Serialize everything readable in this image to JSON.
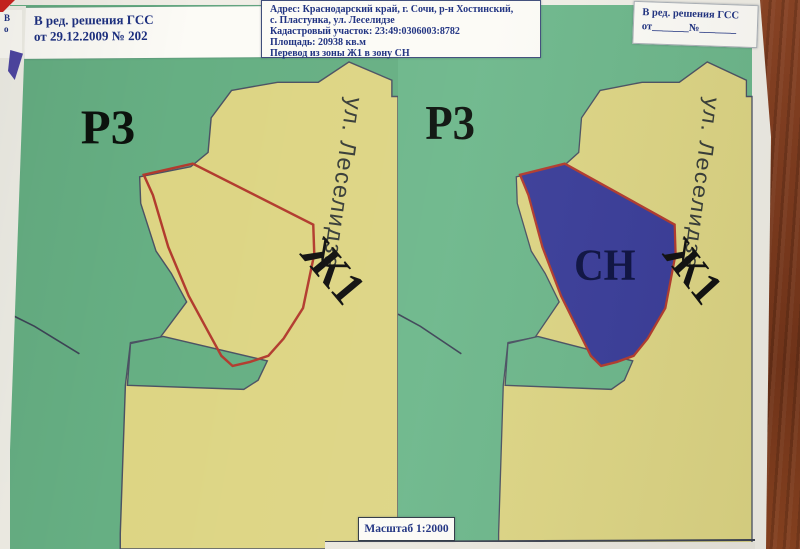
{
  "edit_note_left": {
    "line1": "В ред. решения ГСС",
    "line2": "от 29.12.2009 № 202"
  },
  "address_block": {
    "line1": "Адрес: Краснодарский край, г. Сочи, р-н Хостинский,",
    "line2": "с. Пластунка, ул. Леселидзе",
    "line3": "Кадастровый участок: 23:49:0306003:8782",
    "line4": "Площадь: 20938 кв.м",
    "line5": "Перевод из зоны Ж1 в зону СН"
  },
  "edit_note_right": {
    "line1": "В ред. решения ГСС",
    "line2": "от_______№_______"
  },
  "scale_label": "Масштаб 1:2000",
  "panels": {
    "left": {
      "zone_p3": "Р3",
      "zone_zh1": "Ж1",
      "street": "ул. Леселидзе"
    },
    "right": {
      "zone_p3": "Р3",
      "zone_zh1": "Ж1",
      "zone_cn": "СН",
      "street": "ул. Леселидзе"
    }
  },
  "underlay_fragment": {
    "line1": "В",
    "line2": "о"
  },
  "colors": {
    "zone_green": "#68b287",
    "zone_yellow": "#ddd584",
    "zone_blue": "#3a3d99",
    "parcel_outline": "#b23b2e",
    "boundary_line": "#4b5263",
    "text_navy": "#1d3080",
    "wood_brown": "#7a3a1e"
  }
}
